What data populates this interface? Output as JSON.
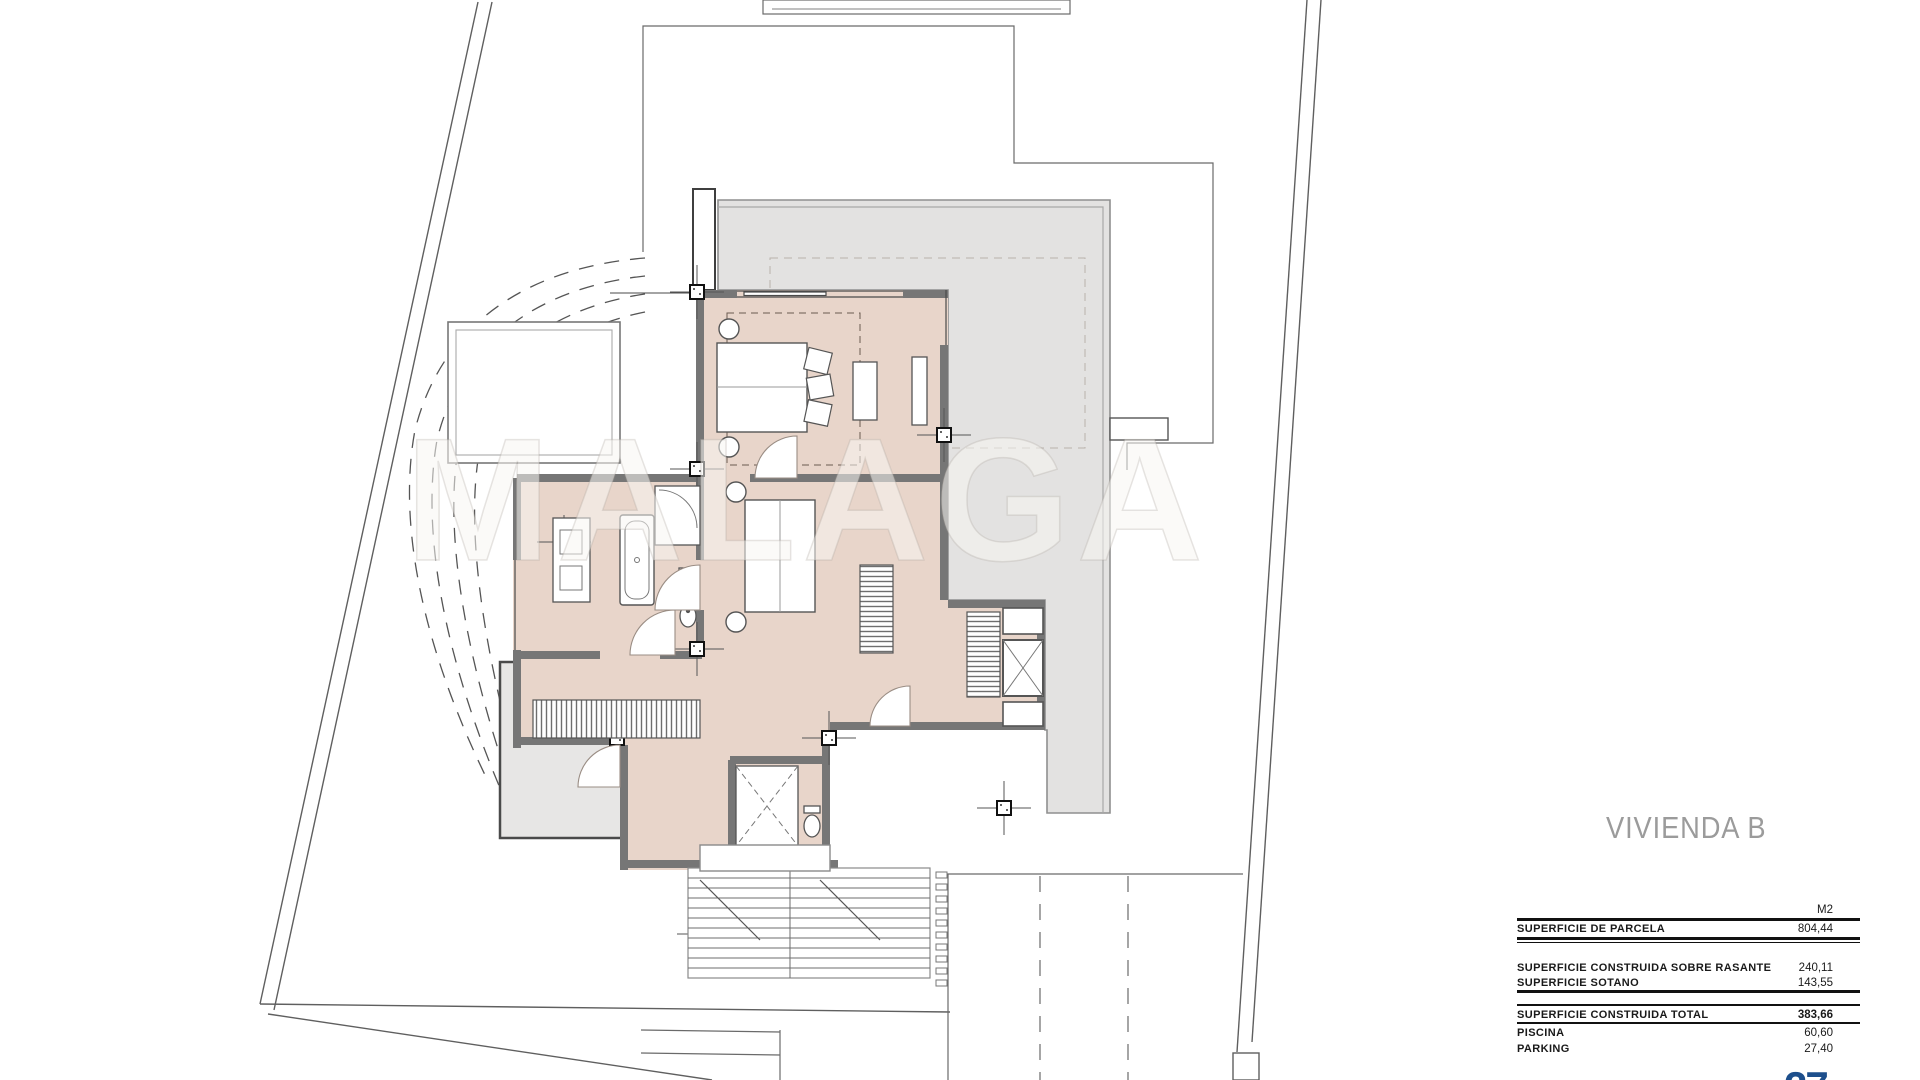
{
  "title": {
    "text": "VIVIENDA B",
    "color": "#9b9b9b"
  },
  "watermark": {
    "text": "MALAGA"
  },
  "areas_table": {
    "unit_header": "M2",
    "rows": [
      {
        "label": "SUPERFICIE DE PARCELA",
        "value": "804,44"
      },
      {
        "label": "SUPERFICIE CONSTRUIDA SOBRE RASANTE",
        "value": "240,11"
      },
      {
        "label": "SUPERFICIE SOTANO",
        "value": "143,55"
      },
      {
        "label": "SUPERFICIE CONSTRUIDA TOTAL",
        "value": "383,66"
      },
      {
        "label": "PISCINA",
        "value": "60,60"
      },
      {
        "label": "PARKING",
        "value": "27,40"
      }
    ]
  },
  "logo": {
    "text": "27",
    "color": "#1d4f8c"
  },
  "colors": {
    "room_floor": "#e8d5ca",
    "walls": "#767676",
    "terrace_gray": "#e3e2e1",
    "lower_terrace_gray": "#e7e6e5",
    "boundary_line": "#5f5f5f",
    "table_text": "#1a1a1a"
  }
}
